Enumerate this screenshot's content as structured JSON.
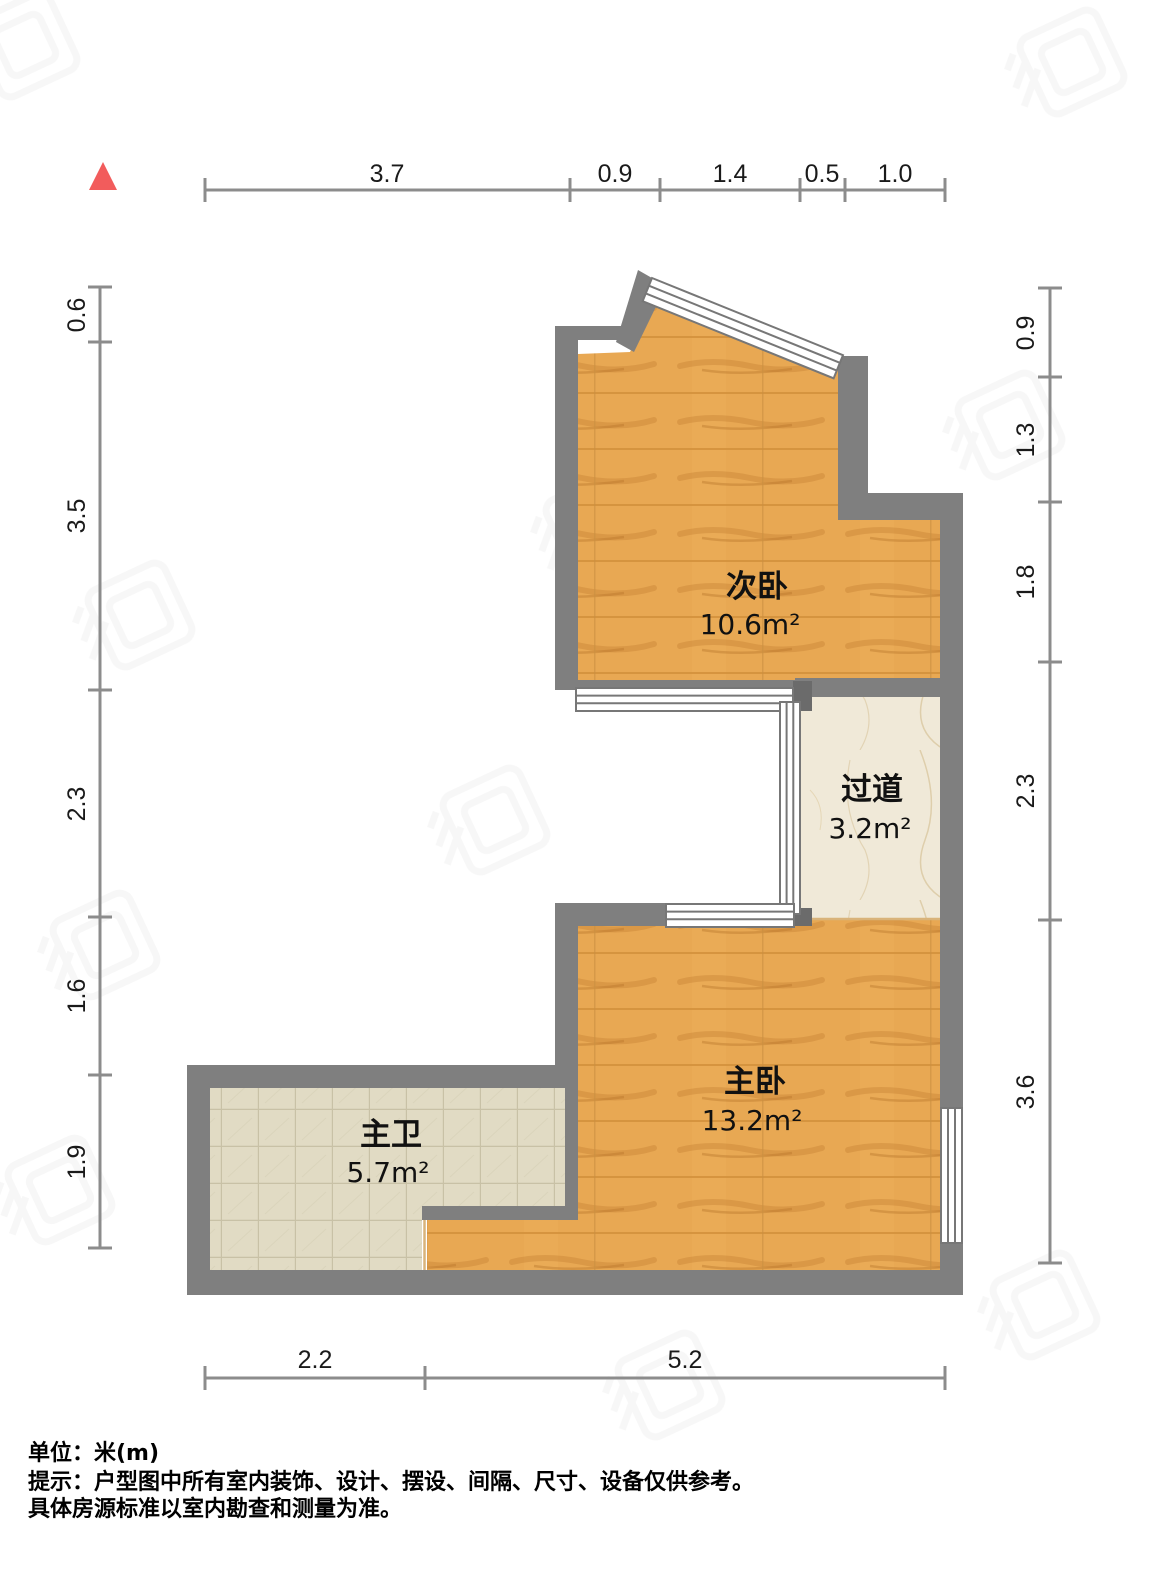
{
  "meta": {
    "type": "residential-floor-plan",
    "orientation_marker": "north-triangle"
  },
  "colors": {
    "background": "#FFFFFF",
    "wall": "#7F7F7F",
    "wall_dark": "#6B6B6B",
    "wood_floor": "#E8A853",
    "wood_grain": "#BF7A2D",
    "bathroom_tile": "#E1DBC4",
    "tile_line": "#C8C1A6",
    "hallway_marble": "#F0E9D8",
    "marble_vein": "#D9C7A0",
    "dimension_line": "#8C8C8C",
    "label_text": "#1A1A1A",
    "north_arrow": "#F25C5C"
  },
  "rooms": {
    "secondary_bedroom": {
      "name": "次卧",
      "area": "10.6m²"
    },
    "hallway": {
      "name": "过道",
      "area": "3.2m²"
    },
    "master_bedroom": {
      "name": "主卧",
      "area": "13.2m²"
    },
    "master_bathroom": {
      "name": "主卫",
      "area": "5.7m²"
    }
  },
  "dimensions": {
    "top": [
      "3.7",
      "0.9",
      "1.4",
      "0.5",
      "1.0"
    ],
    "left": [
      "0.6",
      "3.5",
      "2.3",
      "1.6",
      "1.9"
    ],
    "right": [
      "0.9",
      "1.3",
      "1.8",
      "2.3",
      "3.6"
    ],
    "bottom": [
      "2.2",
      "5.2"
    ]
  },
  "footer": {
    "unit_label": "单位：米(m)",
    "notice_line1": "提示：户型图中所有室内装饰、设计、摆设、间隔、尺寸、设备仅供参考。",
    "notice_line2": "具体房源标准以室内勘查和测量为准。"
  }
}
